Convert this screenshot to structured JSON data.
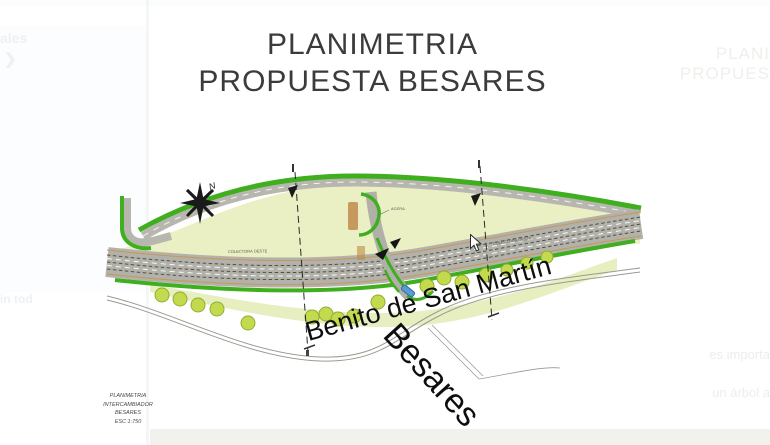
{
  "title": {
    "line1": "PLANIMETRIA",
    "line2": "PROPUESTA BESARES"
  },
  "drawing": {
    "north_label": "N",
    "street_main": "Benito de San Martín",
    "street_cross": "Besares",
    "label_colectora_left": "COLECTORA OESTE",
    "label_colectora_right": "COLECTORA OESTE",
    "label_acera": "ACERA",
    "title_block": {
      "line1": "PLANIMETRIA",
      "line2": "INTERCAMBIADOR",
      "line3": "BESARES",
      "line4": "ESC 1:750"
    },
    "colors": {
      "green_edge": "#3fae1f",
      "pale_green": "#eaefc4",
      "road_gray": "#b2b2aa",
      "tree_fill": "#c3da4e",
      "tree_stroke": "#8fae2f",
      "bridge_tan": "#c08a4a",
      "blue_marker": "#5b9bd5"
    }
  },
  "ghost": {
    "top_left_fragment": "ales",
    "chevron": "❯",
    "left_fragment": "in tod",
    "right_title_line1": "PLANI",
    "right_title_line2": "PROPUES",
    "right_fragment_1": "es importa",
    "right_fragment_2": "un árbol a"
  }
}
